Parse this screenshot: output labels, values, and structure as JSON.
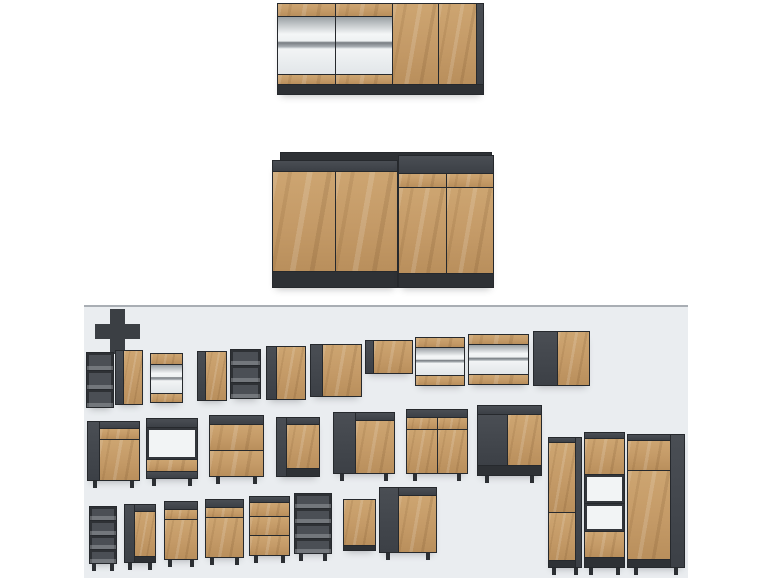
{
  "colors": {
    "wood": "#c49a67",
    "wood_light": "#d6b384",
    "wood_dark": "#aa8050",
    "carcass": "#43474d",
    "carcass_dark": "#2e3135",
    "seam": "#26292d",
    "panel_bg": "#eaedf0",
    "panel_border": "#a9aeb4",
    "page_bg": "#ffffff",
    "glass_shelf": "#8d9398",
    "interior_light": "#f2f4f5"
  },
  "modules": [
    {
      "name": "hero-wall-unit",
      "x": 277,
      "y": 3,
      "w": 207,
      "h": 92,
      "parts": [
        {
          "f": 83,
          "split": "h",
          "parts": [
            {
              "f": 29,
              "parts": [
                {
                  "k": "wood",
                  "f": 13
                },
                {
                  "k": "glass",
                  "f": 60
                },
                {
                  "k": "wood",
                  "f": 10
                }
              ]
            },
            {
              "f": 29,
              "parts": [
                {
                  "k": "wood",
                  "f": 13
                },
                {
                  "k": "glass",
                  "f": 60
                },
                {
                  "k": "wood",
                  "f": 10
                }
              ]
            },
            {
              "f": 23,
              "k": "wood"
            },
            {
              "f": 19,
              "k": "wood"
            },
            {
              "f": 3,
              "k": "dark"
            }
          ]
        },
        {
          "k": "darker",
          "f": 9
        }
      ]
    },
    {
      "name": "hero-base-back-panel",
      "x": 280,
      "y": 152,
      "w": 212,
      "h": 12,
      "parts": [
        {
          "k": "darker"
        }
      ]
    },
    {
      "name": "hero-base-left-unit",
      "x": 272,
      "y": 160,
      "w": 126,
      "h": 128,
      "parts": [
        {
          "k": "dark",
          "f": 10
        },
        {
          "f": 103,
          "split": "h",
          "parts": [
            {
              "k": "wood"
            },
            {
              "k": "wood"
            }
          ]
        },
        {
          "k": "darker",
          "f": 15
        }
      ]
    },
    {
      "name": "hero-base-right-unit",
      "x": 398,
      "y": 155,
      "w": 96,
      "h": 133,
      "parts": [
        {
          "k": "dark",
          "f": 18
        },
        {
          "f": 13,
          "split": "h",
          "parts": [
            {
              "k": "wood"
            },
            {
              "k": "wood"
            }
          ]
        },
        {
          "f": 88,
          "split": "h",
          "parts": [
            {
              "k": "wood"
            },
            {
              "k": "wood"
            }
          ]
        },
        {
          "k": "darker",
          "f": 14
        }
      ]
    },
    {
      "name": "wall-open-shelf-small",
      "x": 86,
      "y": 352,
      "w": 28,
      "h": 56,
      "parts": [
        {
          "k": "open"
        },
        {
          "k": "open"
        },
        {
          "k": "open"
        }
      ]
    },
    {
      "name": "wall-cabinet-door",
      "x": 115,
      "y": 350,
      "w": 28,
      "h": 55,
      "split": "h",
      "parts": [
        {
          "k": "dark",
          "f": 3
        },
        {
          "k": "wood",
          "f": 8
        }
      ]
    },
    {
      "name": "wall-cabinet-glass",
      "x": 150,
      "y": 353,
      "w": 33,
      "h": 50,
      "parts": [
        {
          "k": "wood",
          "f": 11
        },
        {
          "k": "glass",
          "f": 31
        },
        {
          "k": "wood",
          "f": 9
        }
      ]
    },
    {
      "name": "wall-cabinet-door-2",
      "x": 197,
      "y": 351,
      "w": 30,
      "h": 50,
      "split": "h",
      "parts": [
        {
          "k": "dark",
          "f": 3
        },
        {
          "k": "wood",
          "f": 8
        }
      ]
    },
    {
      "name": "wall-open-shelf-2",
      "x": 230,
      "y": 349,
      "w": 31,
      "h": 50,
      "parts": [
        {
          "k": "open"
        },
        {
          "k": "open"
        },
        {
          "k": "open"
        }
      ]
    },
    {
      "name": "wall-cabinet-door-3",
      "x": 266,
      "y": 346,
      "w": 40,
      "h": 54,
      "split": "h",
      "parts": [
        {
          "k": "dark",
          "f": 3
        },
        {
          "k": "wood",
          "f": 10
        }
      ]
    },
    {
      "name": "wall-cabinet-door-4",
      "x": 310,
      "y": 344,
      "w": 52,
      "h": 53,
      "split": "h",
      "parts": [
        {
          "k": "dark",
          "f": 3
        },
        {
          "k": "wood",
          "f": 11
        }
      ]
    },
    {
      "name": "wall-bridge-cabinet",
      "x": 365,
      "y": 340,
      "w": 48,
      "h": 34,
      "split": "h",
      "parts": [
        {
          "k": "dark",
          "f": 2
        },
        {
          "k": "wood",
          "f": 11
        }
      ]
    },
    {
      "name": "wall-glass-horizontal",
      "x": 415,
      "y": 337,
      "w": 50,
      "h": 49,
      "parts": [
        {
          "k": "wood",
          "f": 10
        },
        {
          "k": "glass",
          "f": 28
        },
        {
          "k": "wood",
          "f": 10
        }
      ]
    },
    {
      "name": "wall-glass-horizontal-2",
      "x": 468,
      "y": 334,
      "w": 61,
      "h": 51,
      "parts": [
        {
          "k": "wood",
          "f": 10
        },
        {
          "k": "glass",
          "f": 30
        },
        {
          "k": "wood",
          "f": 10
        }
      ]
    },
    {
      "name": "wall-corner-cabinet",
      "x": 533,
      "y": 331,
      "w": 57,
      "h": 55,
      "split": "h",
      "parts": [
        {
          "k": "dark",
          "f": 5
        },
        {
          "k": "wood",
          "f": 7
        }
      ]
    },
    {
      "name": "base-drawer-door",
      "x": 87,
      "y": 421,
      "w": 53,
      "h": 60,
      "legs": true,
      "split": "h",
      "parts": [
        {
          "k": "dark",
          "f": 3
        },
        {
          "f": 11,
          "parts": [
            {
              "k": "dark",
              "f": 6
            },
            {
              "k": "wood",
              "f": 11
            },
            {
              "k": "wood",
              "f": 43
            }
          ]
        }
      ]
    },
    {
      "name": "base-oven-housing",
      "x": 146,
      "y": 418,
      "w": 52,
      "h": 61,
      "legs": true,
      "parts": [
        {
          "k": "dark",
          "f": 8
        },
        {
          "k": "light",
          "f": 33
        },
        {
          "k": "wood",
          "f": 12
        },
        {
          "k": "dark",
          "f": 6
        }
      ]
    },
    {
      "name": "base-drawers-2",
      "x": 209,
      "y": 415,
      "w": 55,
      "h": 62,
      "legs": true,
      "parts": [
        {
          "k": "dark",
          "f": 8
        },
        {
          "k": "wood",
          "f": 26
        },
        {
          "k": "wood",
          "f": 26
        }
      ]
    },
    {
      "name": "base-door",
      "x": 276,
      "y": 417,
      "w": 44,
      "h": 60,
      "split": "h",
      "parts": [
        {
          "k": "dark",
          "f": 3
        },
        {
          "f": 10,
          "parts": [
            {
              "k": "dark",
              "f": 6
            },
            {
              "k": "wood",
              "f": 46
            },
            {
              "k": "darker",
              "f": 8
            }
          ]
        }
      ]
    },
    {
      "name": "base-door-2",
      "x": 333,
      "y": 412,
      "w": 62,
      "h": 62,
      "legs": true,
      "split": "h",
      "parts": [
        {
          "k": "dark",
          "f": 5
        },
        {
          "f": 9,
          "parts": [
            {
              "k": "dark",
              "f": 7
            },
            {
              "k": "wood",
              "f": 52
            }
          ]
        }
      ]
    },
    {
      "name": "base-drawer-2doors",
      "x": 406,
      "y": 409,
      "w": 62,
      "h": 65,
      "legs": true,
      "parts": [
        {
          "k": "dark",
          "f": 7
        },
        {
          "f": 12,
          "split": "h",
          "parts": [
            {
              "k": "wood"
            },
            {
              "k": "wood"
            }
          ]
        },
        {
          "f": 44,
          "split": "h",
          "parts": [
            {
              "k": "wood"
            },
            {
              "k": "wood"
            }
          ]
        }
      ]
    },
    {
      "name": "base-corner",
      "x": 477,
      "y": 405,
      "w": 65,
      "h": 71,
      "legs": true,
      "parts": [
        {
          "k": "dark",
          "f": 8
        },
        {
          "f": 53,
          "split": "h",
          "parts": [
            {
              "k": "dark",
              "f": 6
            },
            {
              "k": "wood",
              "f": 7
            }
          ]
        },
        {
          "k": "darker",
          "f": 9
        }
      ]
    },
    {
      "name": "base-open-rack",
      "x": 89,
      "y": 506,
      "w": 28,
      "h": 58,
      "legs": true,
      "parts": [
        {
          "k": "open"
        },
        {
          "k": "open"
        },
        {
          "k": "open"
        },
        {
          "k": "open"
        }
      ]
    },
    {
      "name": "base-door-narrow",
      "x": 124,
      "y": 504,
      "w": 32,
      "h": 59,
      "legs": true,
      "split": "h",
      "parts": [
        {
          "k": "dark",
          "f": 4
        },
        {
          "f": 9,
          "parts": [
            {
              "k": "dark",
              "f": 6
            },
            {
              "k": "wood",
              "f": 48
            },
            {
              "k": "darker",
              "f": 6
            }
          ]
        }
      ]
    },
    {
      "name": "base-drawer-door-narrow",
      "x": 164,
      "y": 501,
      "w": 34,
      "h": 59,
      "legs": true,
      "parts": [
        {
          "k": "dark",
          "f": 7
        },
        {
          "k": "wood",
          "f": 10
        },
        {
          "k": "wood",
          "f": 40
        }
      ]
    },
    {
      "name": "base-drawer-door-narrow-2",
      "x": 205,
      "y": 499,
      "w": 39,
      "h": 59,
      "legs": true,
      "parts": [
        {
          "k": "dark",
          "f": 7
        },
        {
          "k": "wood",
          "f": 10
        },
        {
          "k": "wood",
          "f": 40
        }
      ]
    },
    {
      "name": "base-drawers-3",
      "x": 249,
      "y": 496,
      "w": 41,
      "h": 60,
      "legs": true,
      "parts": [
        {
          "k": "dark",
          "f": 5
        },
        {
          "k": "wood",
          "f": 13
        },
        {
          "k": "wood",
          "f": 19
        },
        {
          "k": "wood",
          "f": 19
        }
      ]
    },
    {
      "name": "base-open-unit",
      "x": 294,
      "y": 493,
      "w": 38,
      "h": 61,
      "legs": true,
      "parts": [
        {
          "k": "open"
        },
        {
          "k": "open"
        },
        {
          "k": "open"
        },
        {
          "k": "open"
        }
      ]
    },
    {
      "name": "front-panel-door",
      "x": 343,
      "y": 499,
      "w": 33,
      "h": 52,
      "parts": [
        {
          "k": "wood",
          "f": 12
        },
        {
          "k": "darker",
          "f": 1
        }
      ]
    },
    {
      "name": "base-sink",
      "x": 379,
      "y": 487,
      "w": 58,
      "h": 66,
      "legs": true,
      "split": "h",
      "parts": [
        {
          "k": "dark",
          "f": 5
        },
        {
          "f": 10,
          "parts": [
            {
              "k": "dark",
              "f": 7
            },
            {
              "k": "wood",
              "f": 55
            }
          ]
        }
      ]
    },
    {
      "name": "tall-pantry",
      "x": 548,
      "y": 437,
      "w": 34,
      "h": 131,
      "legs": true,
      "split": "h",
      "parts": [
        {
          "f": 10,
          "parts": [
            {
              "k": "dark",
              "f": 4
            },
            {
              "k": "wood",
              "f": 68
            },
            {
              "k": "wood",
              "f": 46
            },
            {
              "k": "darker",
              "f": 6
            }
          ]
        },
        {
          "k": "dark",
          "f": 2
        }
      ]
    },
    {
      "name": "tall-oven-housing",
      "x": 584,
      "y": 432,
      "w": 41,
      "h": 136,
      "legs": true,
      "parts": [
        {
          "k": "dark",
          "f": 4
        },
        {
          "k": "wood",
          "f": 27
        },
        {
          "k": "light",
          "f": 21
        },
        {
          "k": "light",
          "f": 21
        },
        {
          "k": "wood",
          "f": 19
        },
        {
          "k": "darker",
          "f": 7
        }
      ]
    },
    {
      "name": "tall-fridge-housing",
      "x": 627,
      "y": 434,
      "w": 58,
      "h": 134,
      "legs": true,
      "split": "h",
      "parts": [
        {
          "f": 10,
          "parts": [
            {
              "k": "dark",
              "f": 4
            },
            {
              "k": "wood",
              "f": 24
            },
            {
              "k": "wood",
              "f": 72
            },
            {
              "k": "darker",
              "f": 6
            }
          ]
        },
        {
          "k": "dark",
          "f": 3
        }
      ]
    }
  ]
}
